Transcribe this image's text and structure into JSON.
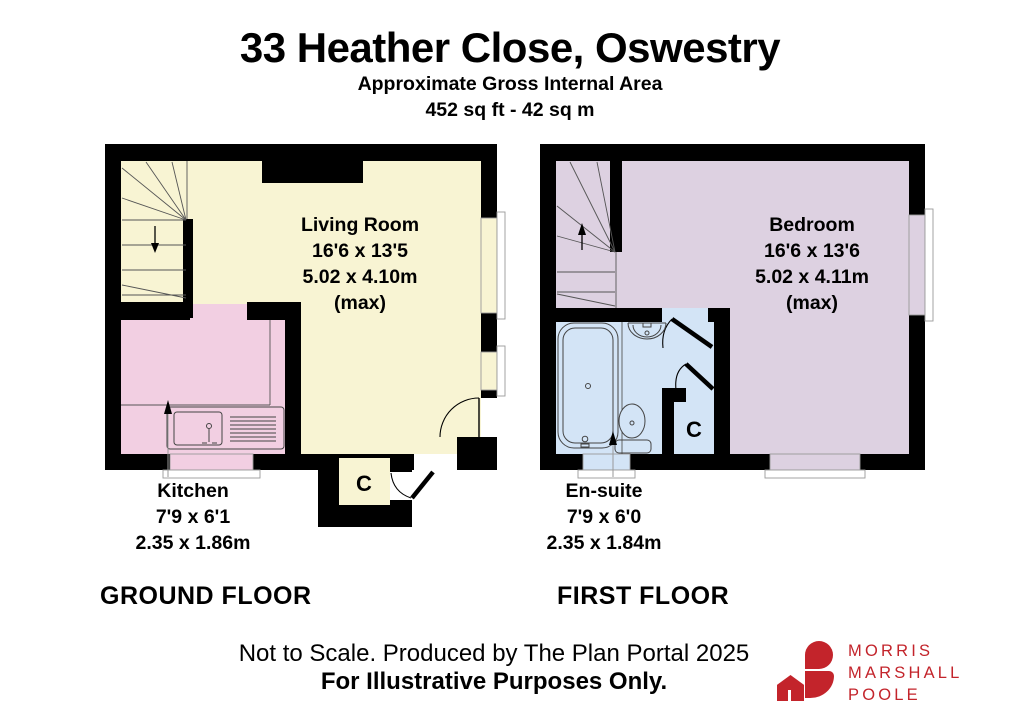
{
  "header": {
    "title": "33 Heather Close, Oswestry",
    "subtitle": "Approximate Gross Internal Area",
    "area": "452 sq ft - 42 sq m"
  },
  "ground_floor": {
    "label": "GROUND FLOOR",
    "living_room": {
      "name": "Living Room",
      "dims_imperial": "16'6 x 13'5",
      "dims_metric": "5.02 x 4.10m",
      "max_note": "(max)"
    },
    "kitchen": {
      "name": "Kitchen",
      "dims_imperial": "7'9 x 6'1",
      "dims_metric": "2.35 x 1.86m"
    },
    "cupboard_label": "C"
  },
  "first_floor": {
    "label": "FIRST FLOOR",
    "bedroom": {
      "name": "Bedroom",
      "dims_imperial": "16'6 x 13'6",
      "dims_metric": "5.02 x 4.11m",
      "max_note": "(max)"
    },
    "ensuite": {
      "name": "En-suite",
      "dims_imperial": "7'9 x 6'0",
      "dims_metric": "2.35 x 1.84m"
    },
    "cupboard_label": "C"
  },
  "footer": {
    "line1": "Not to Scale. Produced by The Plan Portal 2025",
    "line2": "For Illustrative Purposes Only."
  },
  "logo": {
    "icon_name": "house-logo-icon",
    "line1": "MORRIS",
    "line2": "MARSHALL",
    "line3": "POOLE"
  },
  "colors": {
    "wall": "#000000",
    "living_room": "#f8f4d3",
    "kitchen": "#f2cfe2",
    "bedroom": "#ddd1e1",
    "ensuite": "#d3e4f6",
    "logo_red": "#c3242b"
  }
}
